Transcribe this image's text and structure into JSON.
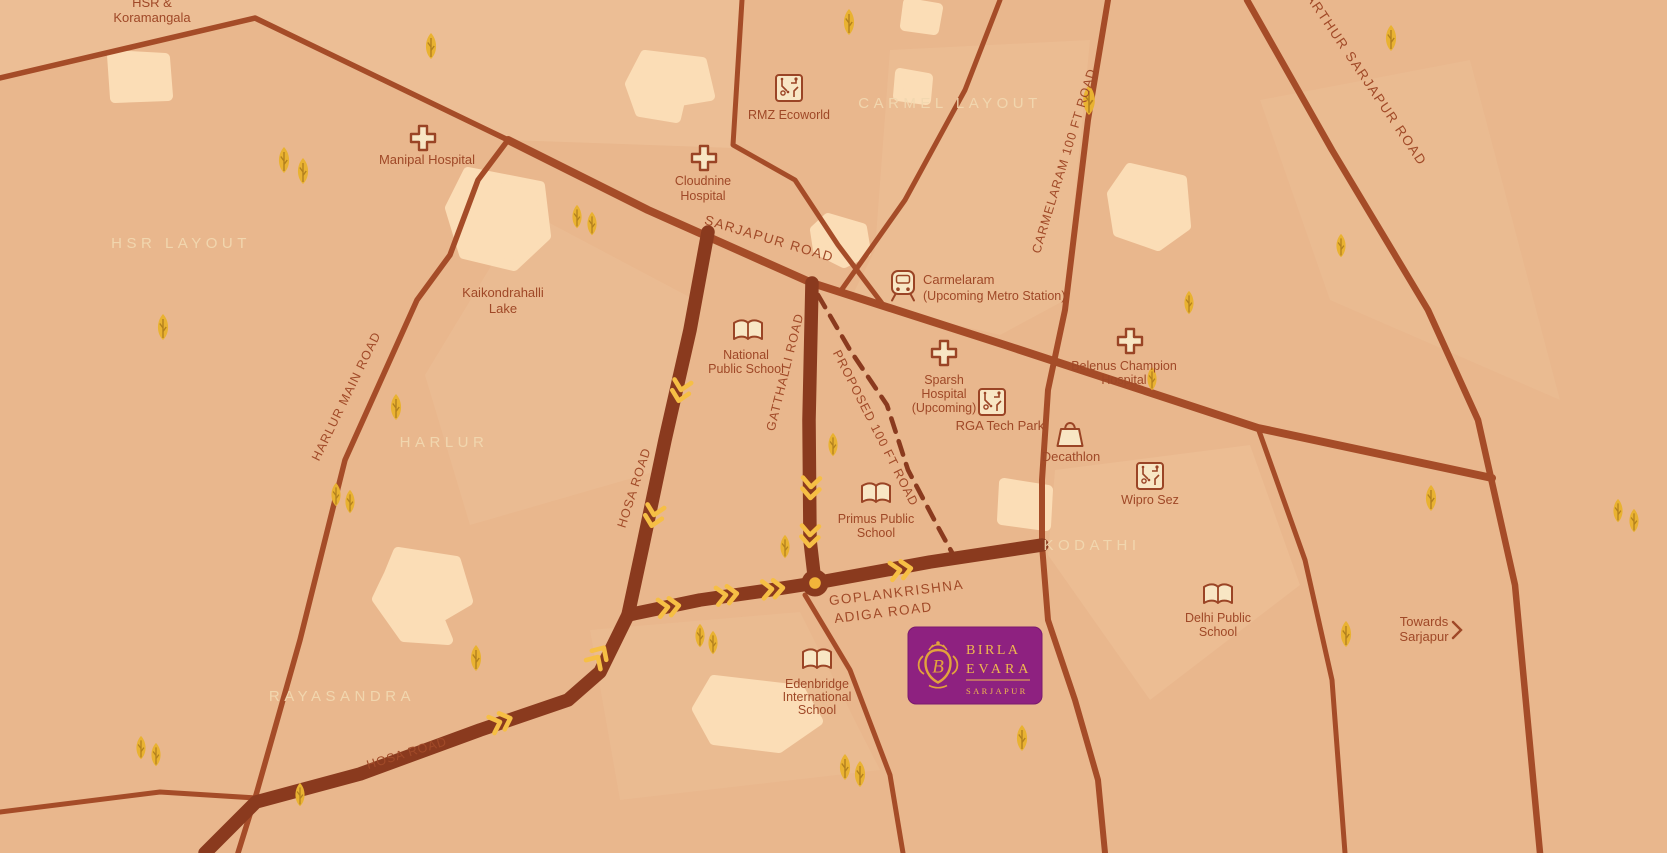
{
  "colors": {
    "background": "#e9b78d",
    "light_patch": "#f0c69e",
    "cream_blob": "#fbddb6",
    "road": "#a54c28",
    "route_road": "#8a3a1e",
    "label_text": "#9f4827",
    "area_text": "#f2d8b0",
    "tree_gold": "#e9b231",
    "chevron_gold": "#f6bf45",
    "badge_purple": "#8e2180",
    "badge_gold": "#efb94e"
  },
  "areas": {
    "hsr_layout": "HSR LAYOUT",
    "carmel_layout": "CARMEL LAYOUT",
    "harlur": "HARLUR",
    "kodathi": "KODATHI",
    "rayasandra": "RAYASANDRA"
  },
  "directions": {
    "northwest": {
      "line1": "HSR &",
      "line2": "Koramangala"
    },
    "southeast": {
      "line1": "Towards",
      "line2": "Sarjapur"
    }
  },
  "roads": {
    "sarjapur": "SARJAPUR ROAD",
    "varthur_sarjapur": "VARTHUR SARJAPUR ROAD",
    "carmelaram_100ft": "CARMELARAM 100 FT ROAD",
    "gatthalli": "GATTHALLI ROAD",
    "harlur_main": "HARLUR MAIN ROAD",
    "hosa": "HOSA ROAD",
    "hosa_bottom": "HOSA ROAD",
    "proposed_100ft": "PROPOSED 100 FT ROAD",
    "goplankrishna_line1": "GOPLANKRISHNA",
    "goplankrishna_line2": "ADIGA ROAD"
  },
  "places": {
    "manipal": {
      "label": "Manipal Hospital",
      "icon": "hospital-cross-icon"
    },
    "rmz": {
      "label": "RMZ Ecoworld",
      "icon": "tech-park-icon"
    },
    "cloudnine": {
      "line1": "Cloudnine",
      "line2": "Hospital",
      "icon": "hospital-cross-icon"
    },
    "carmelaram_metro": {
      "line1": "Carmelaram",
      "line2": "(Upcoming Metro Station)",
      "icon": "metro-station-icon"
    },
    "kaikondrahalli": {
      "line1": "Kaikondrahalli",
      "line2": "Lake"
    },
    "national_ps": {
      "line1": "National",
      "line2": "Public School",
      "icon": "school-book-icon"
    },
    "sparsh": {
      "line1": "Sparsh",
      "line2": "Hospital",
      "line3": "(Upcoming)",
      "icon": "hospital-cross-icon"
    },
    "rga": {
      "label": "RGA Tech Park",
      "icon": "tech-park-icon"
    },
    "belenus": {
      "line1": "Belenus Champion",
      "line2": "Hospital",
      "icon": "hospital-cross-icon"
    },
    "decathlon": {
      "label": "Decathlon",
      "icon": "shopping-bag-icon"
    },
    "wipro": {
      "label": "Wipro Sez",
      "icon": "tech-park-icon"
    },
    "primus": {
      "line1": "Primus Public",
      "line2": "School",
      "icon": "school-book-icon"
    },
    "edenbridge": {
      "line1": "Edenbridge",
      "line2": "International",
      "line3": "School",
      "icon": "school-book-icon"
    },
    "delhi_ps": {
      "line1": "Delhi Public",
      "line2": "School",
      "icon": "school-book-icon"
    }
  },
  "project_badge": {
    "brand": "BIRLA",
    "name": "EVARA",
    "location": "SARJAPUR"
  }
}
